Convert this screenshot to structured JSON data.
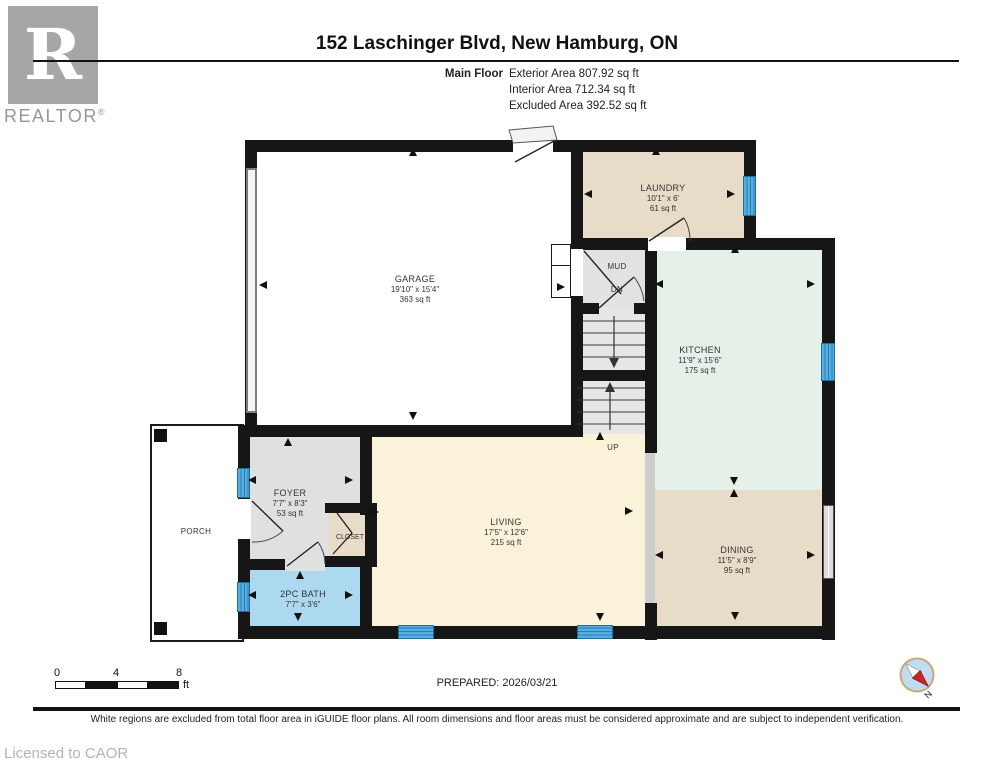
{
  "logo": {
    "letter": "R",
    "brand": "REALTOR",
    "reg": "®"
  },
  "header": {
    "title": "152 Laschinger Blvd, New Hamburg, ON",
    "floor_label": "Main Floor",
    "area_lines": [
      "Exterior Area 807.92 sq ft",
      "Interior Area 712.34 sq ft",
      "Excluded Area 392.52 sq ft"
    ]
  },
  "rooms": {
    "garage": {
      "name": "GARAGE",
      "dims": "19'10\" x 15'4\"",
      "area": "363 sq ft"
    },
    "laundry": {
      "name": "LAUNDRY",
      "dims": "10'1\" x 6'",
      "area": "61 sq ft"
    },
    "kitchen": {
      "name": "KITCHEN",
      "dims": "11'9\" x 15'6\"",
      "area": "175 sq ft"
    },
    "dining": {
      "name": "DINING",
      "dims": "11'5\" x 8'9\"",
      "area": "95 sq ft"
    },
    "living": {
      "name": "LIVING",
      "dims": "17'5\" x 12'6\"",
      "area": "215 sq ft"
    },
    "foyer": {
      "name": "FOYER",
      "dims": "7'7\" x 8'3\"",
      "area": "53 sq ft"
    },
    "bath": {
      "name": "2PC BATH",
      "dims": "7'7\" x 3'6\""
    },
    "mud": {
      "name": "MUD"
    },
    "closet": {
      "name": "CLOSET"
    },
    "porch": {
      "name": "PORCH"
    }
  },
  "stairs": {
    "up_label": "UP",
    "down_label": "DN"
  },
  "footer": {
    "scale": {
      "ticks": [
        "0",
        "4",
        "8"
      ],
      "unit": "ft"
    },
    "prepared": "PREPARED: 2026/03/21",
    "disclaimer": "White regions are excluded from total floor area in iGUIDE floor plans. All room dimensions and floor areas must be considered approximate and are subject to independent verification.",
    "license": "Licensed to CAOR",
    "compass_north": "N"
  },
  "colors": {
    "wall": "#161616",
    "laundry_dining_closet": "#e7dcc8",
    "kitchen": "#e5f0e9",
    "living": "#faf3da",
    "bath": "#add9f0",
    "foyer_mud_stairs": "#e0e0e0",
    "window": "#4fa8dc",
    "compass_fill": "#bfdcf1",
    "compass_needle": "#cc2222"
  }
}
